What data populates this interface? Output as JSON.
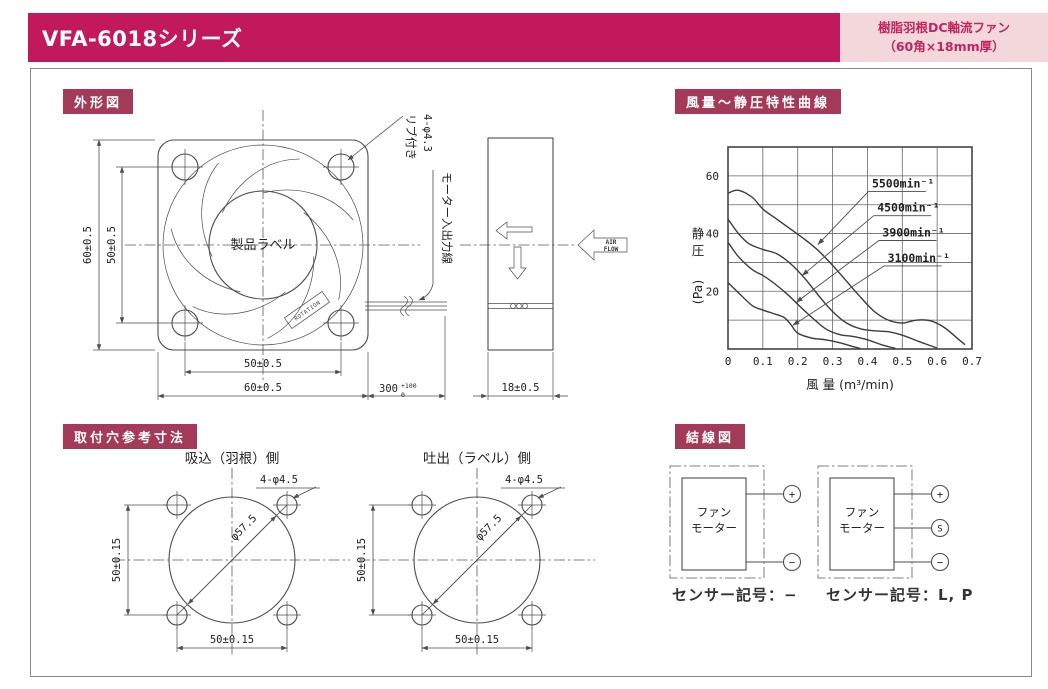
{
  "header": {
    "title": "VFA-6018シリーズ",
    "tag_line1": "樹脂羽根DC軸流ファン",
    "tag_line2": "（60角×18mm厚）",
    "bar_color": "#c2195c",
    "tag_bg": "#f2d8da",
    "tag_text_color": "#c22360"
  },
  "badges": {
    "outline": "外形図",
    "curve": "風量～静圧特性曲線",
    "mounting": "取付穴参考寸法",
    "wiring": "結線図",
    "bg_color": "#a43a57"
  },
  "outline": {
    "dim_height_outer": "60±0.5",
    "dim_height_inner": "50±0.5",
    "dim_width_inner": "50±0.5",
    "dim_width_outer": "60±0.5",
    "product_label": "製品ラベル",
    "rotation_label": "ROTATION",
    "rib_callout_line1": "リブ付き",
    "rib_callout_line2": "4-φ4.3",
    "lead_wire_label": "モーター入出力線",
    "wire_length": "300",
    "wire_tol_plus": "+100",
    "wire_tol_minus": "0",
    "dim_thickness": "18±0.5",
    "airflow_line1": "AIR",
    "airflow_line2": "FLOW"
  },
  "mounting": {
    "left": {
      "title": "吸込（羽根）側",
      "hole_callout": "4-φ4.5",
      "diameter": "φ57.5",
      "dim_vertical": "50±0.15",
      "dim_horizontal": "50±0.15"
    },
    "right": {
      "title": "吐出（ラベル）側",
      "hole_callout": "4-φ4.5",
      "diameter": "φ57.5",
      "dim_vertical": "50±0.15",
      "dim_horizontal": "50±0.15"
    }
  },
  "wiring": {
    "left": {
      "box_line1": "ファン",
      "box_line2": "モーター",
      "terminals": [
        "+",
        "−"
      ],
      "caption": "センサー記号：−"
    },
    "right": {
      "box_line1": "ファン",
      "box_line2": "モーター",
      "terminals": [
        "+",
        "S",
        "−"
      ],
      "caption": "センサー記号：L, P"
    }
  },
  "chart_data": {
    "type": "line",
    "title": "風量～静圧特性曲線",
    "xlabel": "風 量 (m³/min)",
    "ylabel": "静 圧 (Pa)",
    "xlim": [
      0,
      0.7
    ],
    "ylim": [
      0,
      70
    ],
    "grid": true,
    "grid_x_step": 0.1,
    "grid_y_step": 10,
    "x_ticks": [
      0,
      0.1,
      0.2,
      0.3,
      0.4,
      0.5,
      0.6,
      0.7
    ],
    "y_ticks": [
      20,
      40,
      60
    ],
    "legend_position": "inline-arrow-labels",
    "series": [
      {
        "name": "5500min⁻¹",
        "rpm": 5500,
        "points": [
          [
            0,
            54
          ],
          [
            0.03,
            55
          ],
          [
            0.07,
            52.5
          ],
          [
            0.1,
            48.5
          ],
          [
            0.14,
            45
          ],
          [
            0.18,
            41.5
          ],
          [
            0.22,
            38
          ],
          [
            0.26,
            34
          ],
          [
            0.3,
            29
          ],
          [
            0.34,
            23.5
          ],
          [
            0.38,
            18
          ],
          [
            0.42,
            13
          ],
          [
            0.46,
            10
          ],
          [
            0.5,
            9
          ],
          [
            0.54,
            10
          ],
          [
            0.58,
            9.8
          ],
          [
            0.62,
            7.5
          ],
          [
            0.66,
            3.5
          ],
          [
            0.68,
            1.5
          ]
        ],
        "label_pos": [
          0.413,
          56
        ],
        "underline": [
          [
            0.403,
            54.6
          ],
          [
            0.568,
            54.6
          ]
        ],
        "arrow_tip": [
          0.258,
          36.2
        ]
      },
      {
        "name": "4500min⁻¹",
        "rpm": 4500,
        "points": [
          [
            0,
            45
          ],
          [
            0.03,
            40
          ],
          [
            0.06,
            36.5
          ],
          [
            0.1,
            34.5
          ],
          [
            0.14,
            33
          ],
          [
            0.18,
            29.5
          ],
          [
            0.22,
            24.5
          ],
          [
            0.26,
            18.5
          ],
          [
            0.3,
            13
          ],
          [
            0.34,
            9
          ],
          [
            0.38,
            7
          ],
          [
            0.42,
            6.3
          ],
          [
            0.46,
            6
          ],
          [
            0.5,
            4.8
          ],
          [
            0.55,
            2.5
          ],
          [
            0.6,
            0.3
          ]
        ],
        "label_pos": [
          0.428,
          47.6
        ],
        "underline": [
          [
            0.418,
            46.2
          ],
          [
            0.583,
            46.2
          ]
        ],
        "arrow_tip": [
          0.213,
          25.5
        ]
      },
      {
        "name": "3900min⁻¹",
        "rpm": 3900,
        "points": [
          [
            0,
            37
          ],
          [
            0.03,
            32
          ],
          [
            0.07,
            27.5
          ],
          [
            0.1,
            25.5
          ],
          [
            0.13,
            23
          ],
          [
            0.17,
            19
          ],
          [
            0.2,
            15.5
          ],
          [
            0.24,
            11
          ],
          [
            0.28,
            7
          ],
          [
            0.32,
            5
          ],
          [
            0.36,
            4.3
          ],
          [
            0.4,
            3.2
          ],
          [
            0.44,
            1.5
          ],
          [
            0.48,
            0.2
          ]
        ],
        "label_pos": [
          0.443,
          39
        ],
        "underline": [
          [
            0.433,
            37.6
          ],
          [
            0.598,
            37.6
          ]
        ],
        "arrow_tip": [
          0.196,
          16.2
        ]
      },
      {
        "name": "3100min⁻¹",
        "rpm": 3100,
        "points": [
          [
            0,
            23
          ],
          [
            0.03,
            19.5
          ],
          [
            0.07,
            15
          ],
          [
            0.1,
            13.5
          ],
          [
            0.13,
            12.3
          ],
          [
            0.16,
            11
          ],
          [
            0.18,
            8.5
          ],
          [
            0.2,
            5.5
          ],
          [
            0.24,
            3.8
          ],
          [
            0.28,
            3.2
          ],
          [
            0.32,
            2.2
          ],
          [
            0.36,
            0.8
          ],
          [
            0.38,
            0.2
          ]
        ],
        "label_pos": [
          0.458,
          30.2
        ],
        "underline": [
          [
            0.448,
            28.8
          ],
          [
            0.613,
            28.8
          ]
        ],
        "arrow_tip": [
          0.186,
          8.2
        ]
      }
    ]
  }
}
